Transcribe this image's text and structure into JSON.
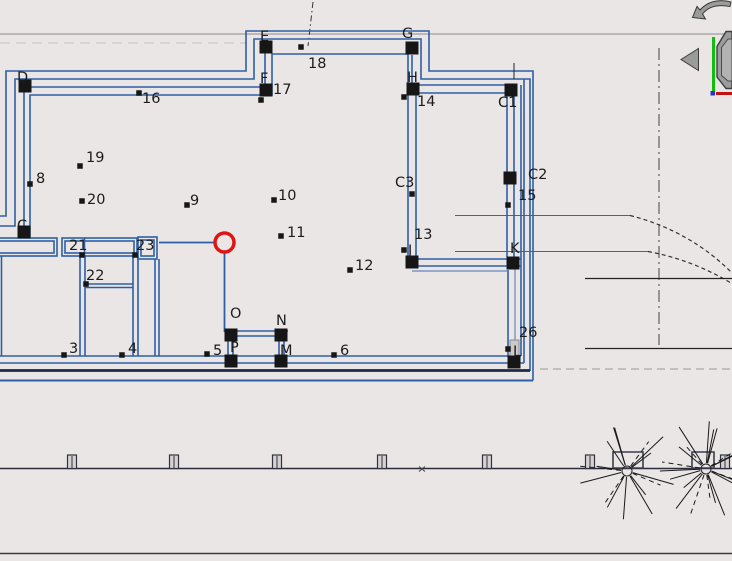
{
  "app": {
    "title": "CAD plan viewport",
    "view": "2D floor plan"
  },
  "colors": {
    "background": "#EAE6E5",
    "wall_blue": "#2E5FA6",
    "wall_dark_navy": "#1B2A47",
    "marker_black": "#161616",
    "highlight_red": "#E11414",
    "site_line": "#2B2B3B",
    "road_gray": "#606060",
    "widget_gray": "#9B9B9B",
    "axis_y_green": "#12BC12",
    "axis_x_red": "#C41111"
  },
  "selection": {
    "x": 224.5,
    "y": 242.5,
    "radius": 9.5,
    "note": "red circle highlight on plan corner point"
  },
  "plan": {
    "corner_points": [
      {
        "label": "D",
        "point": [
          25,
          86
        ],
        "label_pos": [
          17,
          82
        ]
      },
      {
        "label": "C",
        "point": [
          24,
          232
        ],
        "label_pos": [
          17,
          230
        ]
      },
      {
        "label": "E",
        "point": [
          266,
          47
        ],
        "label_pos": [
          260,
          41
        ]
      },
      {
        "label": "F",
        "point": [
          266,
          90
        ],
        "label_pos": [
          260,
          83
        ]
      },
      {
        "label": "G",
        "point": [
          412,
          48
        ],
        "label_pos": [
          402,
          38
        ]
      },
      {
        "label": "H",
        "point": [
          413,
          89
        ],
        "label_pos": [
          407,
          82
        ]
      },
      {
        "label": "C1",
        "point": [
          511,
          90
        ],
        "label_pos": [
          498,
          107
        ]
      },
      {
        "label": "C2",
        "point": [
          510,
          178
        ],
        "label_pos": [
          528,
          179
        ]
      },
      {
        "label": "J",
        "point": [
          412,
          262
        ],
        "label_pos": [
          408,
          255
        ]
      },
      {
        "label": "K",
        "point": [
          513,
          263
        ],
        "label_pos": [
          510,
          253
        ]
      },
      {
        "label": "L",
        "point": [
          514,
          362
        ],
        "label_pos": [
          513,
          356
        ]
      },
      {
        "label": "O",
        "point": [
          231,
          335
        ],
        "label_pos": [
          230,
          318
        ]
      },
      {
        "label": "N",
        "point": [
          281,
          335
        ],
        "label_pos": [
          276,
          325
        ]
      },
      {
        "label": "P",
        "point": [
          231,
          361
        ],
        "label_pos": [
          230,
          352
        ]
      },
      {
        "label": "M",
        "point": [
          281,
          361
        ],
        "label_pos": [
          280,
          355
        ]
      }
    ],
    "survey_points": [
      {
        "label": "C3",
        "point": [
          412,
          194
        ],
        "label_pos": [
          395,
          187
        ]
      },
      {
        "label": "3",
        "point": [
          64,
          355
        ],
        "label_pos": [
          69,
          353
        ]
      },
      {
        "label": "4",
        "point": [
          122,
          355
        ],
        "label_pos": [
          128,
          353
        ]
      },
      {
        "label": "5",
        "point": [
          207,
          354
        ],
        "label_pos": [
          213,
          355
        ]
      },
      {
        "label": "6",
        "point": [
          334,
          355
        ],
        "label_pos": [
          340,
          355
        ]
      },
      {
        "label": "8",
        "point": [
          30,
          184
        ],
        "label_pos": [
          36,
          183
        ]
      },
      {
        "label": "9",
        "point": [
          187,
          205
        ],
        "label_pos": [
          190,
          205
        ]
      },
      {
        "label": "10",
        "point": [
          274,
          200
        ],
        "label_pos": [
          278,
          200
        ]
      },
      {
        "label": "11",
        "point": [
          281,
          236
        ],
        "label_pos": [
          287,
          237
        ]
      },
      {
        "label": "12",
        "point": [
          350,
          270
        ],
        "label_pos": [
          355,
          270
        ]
      },
      {
        "label": "13",
        "point": [
          404,
          250
        ],
        "label_pos": [
          414,
          239
        ]
      },
      {
        "label": "14",
        "point": [
          404,
          97
        ],
        "label_pos": [
          417,
          106
        ]
      },
      {
        "label": "15",
        "point": [
          508,
          205
        ],
        "label_pos": [
          518,
          200
        ]
      },
      {
        "label": "16",
        "point": [
          139,
          93
        ],
        "label_pos": [
          142,
          103
        ]
      },
      {
        "label": "17",
        "point": [
          261,
          100
        ],
        "label_pos": [
          273,
          94
        ]
      },
      {
        "label": "18",
        "point": [
          301,
          47
        ],
        "label_pos": [
          308,
          68
        ]
      },
      {
        "label": "19",
        "point": [
          80,
          166
        ],
        "label_pos": [
          86,
          162
        ]
      },
      {
        "label": "20",
        "point": [
          82,
          201
        ],
        "label_pos": [
          87,
          204
        ]
      },
      {
        "label": "21",
        "point": [
          82,
          255
        ],
        "label_pos": [
          69,
          250
        ]
      },
      {
        "label": "22",
        "point": [
          86,
          284
        ],
        "label_pos": [
          86,
          280
        ]
      },
      {
        "label": "23",
        "point": [
          135,
          255
        ],
        "label_pos": [
          136,
          250
        ]
      },
      {
        "label": "26",
        "point": [
          508,
          349
        ],
        "label_pos": [
          519,
          337
        ]
      }
    ]
  },
  "site": {
    "fence_posts_x": [
      72,
      174,
      277,
      382,
      487,
      590,
      725
    ],
    "planters": [
      {
        "x": 613,
        "width": 30
      },
      {
        "x": 692,
        "width": 22
      }
    ],
    "trees": [
      {
        "cx": 627,
        "cy": 471,
        "radius": 50,
        "branches": 16,
        "seed": 0.4
      },
      {
        "cx": 706,
        "cy": 469,
        "radius": 50,
        "branches": 21,
        "seed": 1.9
      }
    ]
  },
  "nav": {
    "icons": [
      {
        "name": "rotate-view-arrow"
      },
      {
        "name": "pan-west-arrow"
      },
      {
        "name": "view-cube"
      }
    ]
  }
}
